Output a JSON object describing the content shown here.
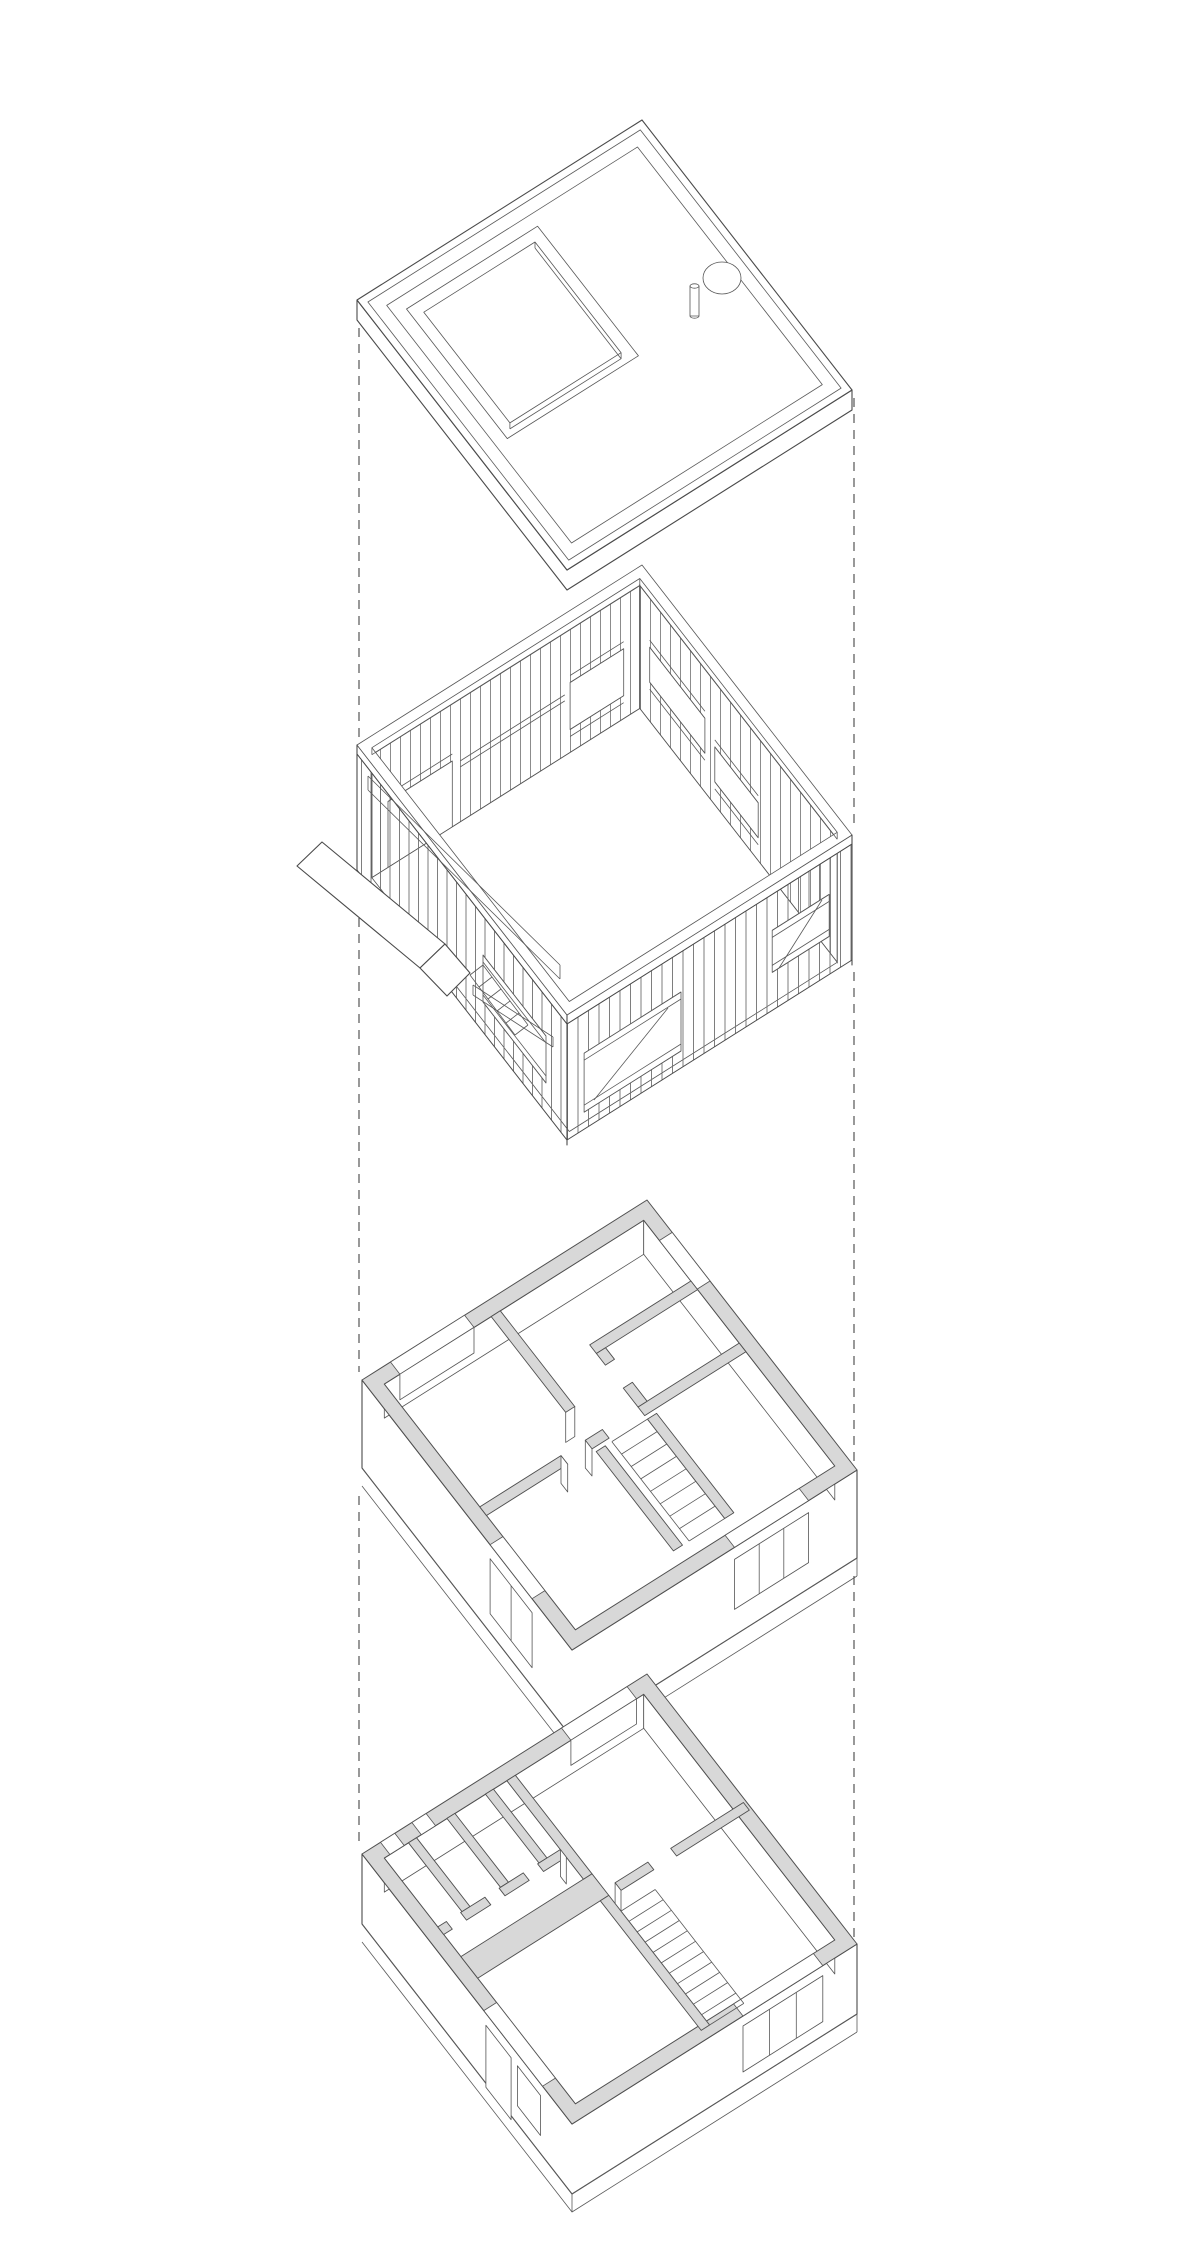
{
  "page": {
    "background": "#ffffff"
  },
  "palette": {
    "line": "#4a4a4a",
    "line_light": "#777777",
    "wall_cut_fill": "#d8d8d8",
    "guide_dash": "#555555",
    "paper": "#ffffff"
  },
  "diagram": {
    "kind": "exploded axonometric drawing of a two-storey house",
    "text_visible": "",
    "guide_lines": {
      "style": "dashed vertical projection lines",
      "count": 2
    },
    "levels": [
      {
        "label": "roof plan with parapet, roof opening, skylight dome and vent pipe"
      },
      {
        "label": "upper level stud framing with window openings, exterior stair and canopy"
      },
      {
        "label": "upper floor plan with rooms, bathroom and stair"
      },
      {
        "label": "ground floor plan with entry cells, living rooms and stair"
      }
    ],
    "stairs": {
      "upper_floor_treads": 9,
      "ground_floor_treads": 12,
      "exterior_steps": 5
    }
  }
}
